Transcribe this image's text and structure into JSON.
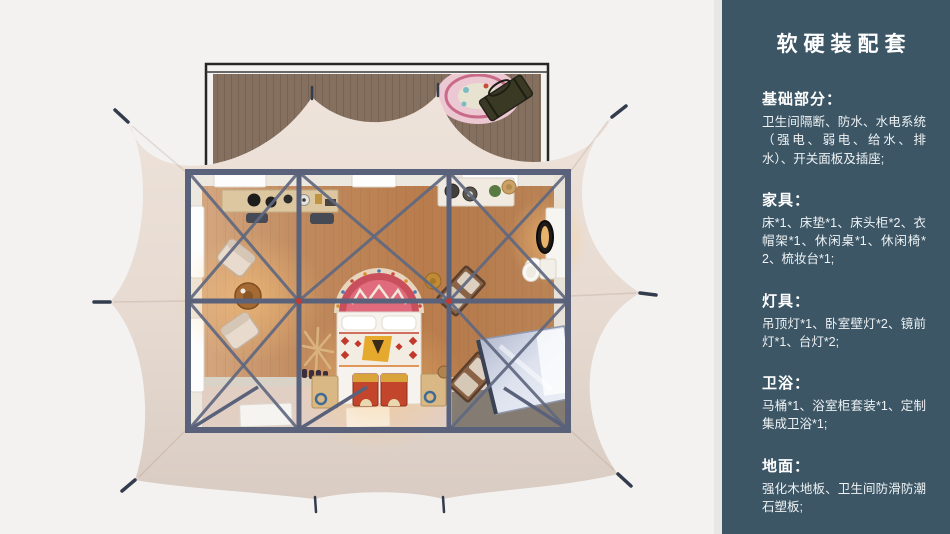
{
  "sidebar": {
    "title": "软硬装配套",
    "sections": [
      {
        "heading": "基础部分：",
        "body": "卫生间隔断、防水、水电系统（强电、弱电、给水、排水）、开关面板及插座;"
      },
      {
        "heading": "家具：",
        "body": "床*1、床垫*1、床头柜*2、衣帽架*1、休闲桌*1、休闲椅*2、梳妆台*1;"
      },
      {
        "heading": "灯具：",
        "body": "吊顶灯*1、卧室壁灯*2、镜前灯*1、台灯*2;"
      },
      {
        "heading": "卫浴：",
        "body": "马桶*1、浴室柜套装*1、定制集成卫浴*1;"
      },
      {
        "heading": "地面：",
        "body": "强化木地板、卫生间防滑防潮石塑板;"
      }
    ]
  },
  "floorplan": {
    "elements": [
      "tent-canvas",
      "wood-deck",
      "deck-rug",
      "deck-bench",
      "steel-frame",
      "cross-braces",
      "wood-floor",
      "console-table",
      "lounge-armchairs",
      "coffee-table",
      "coat-rack",
      "double-bed",
      "headboard-tapestry",
      "storage-chests",
      "nightstands",
      "washbasin-counter",
      "vanity-with-mirror",
      "vanity-stool",
      "toilet",
      "wood-recliners",
      "shower-cabin",
      "door-mats",
      "tent-pegs"
    ],
    "palette": {
      "sidebar_background": "#3c5666",
      "tent_canvas": "#e9ddd3",
      "steel_frame": "#59627a",
      "wood_floor": "#c08a5e",
      "deck_wood": "#85705f",
      "accent_red": "#c2452c",
      "text": "#ffffff"
    }
  }
}
